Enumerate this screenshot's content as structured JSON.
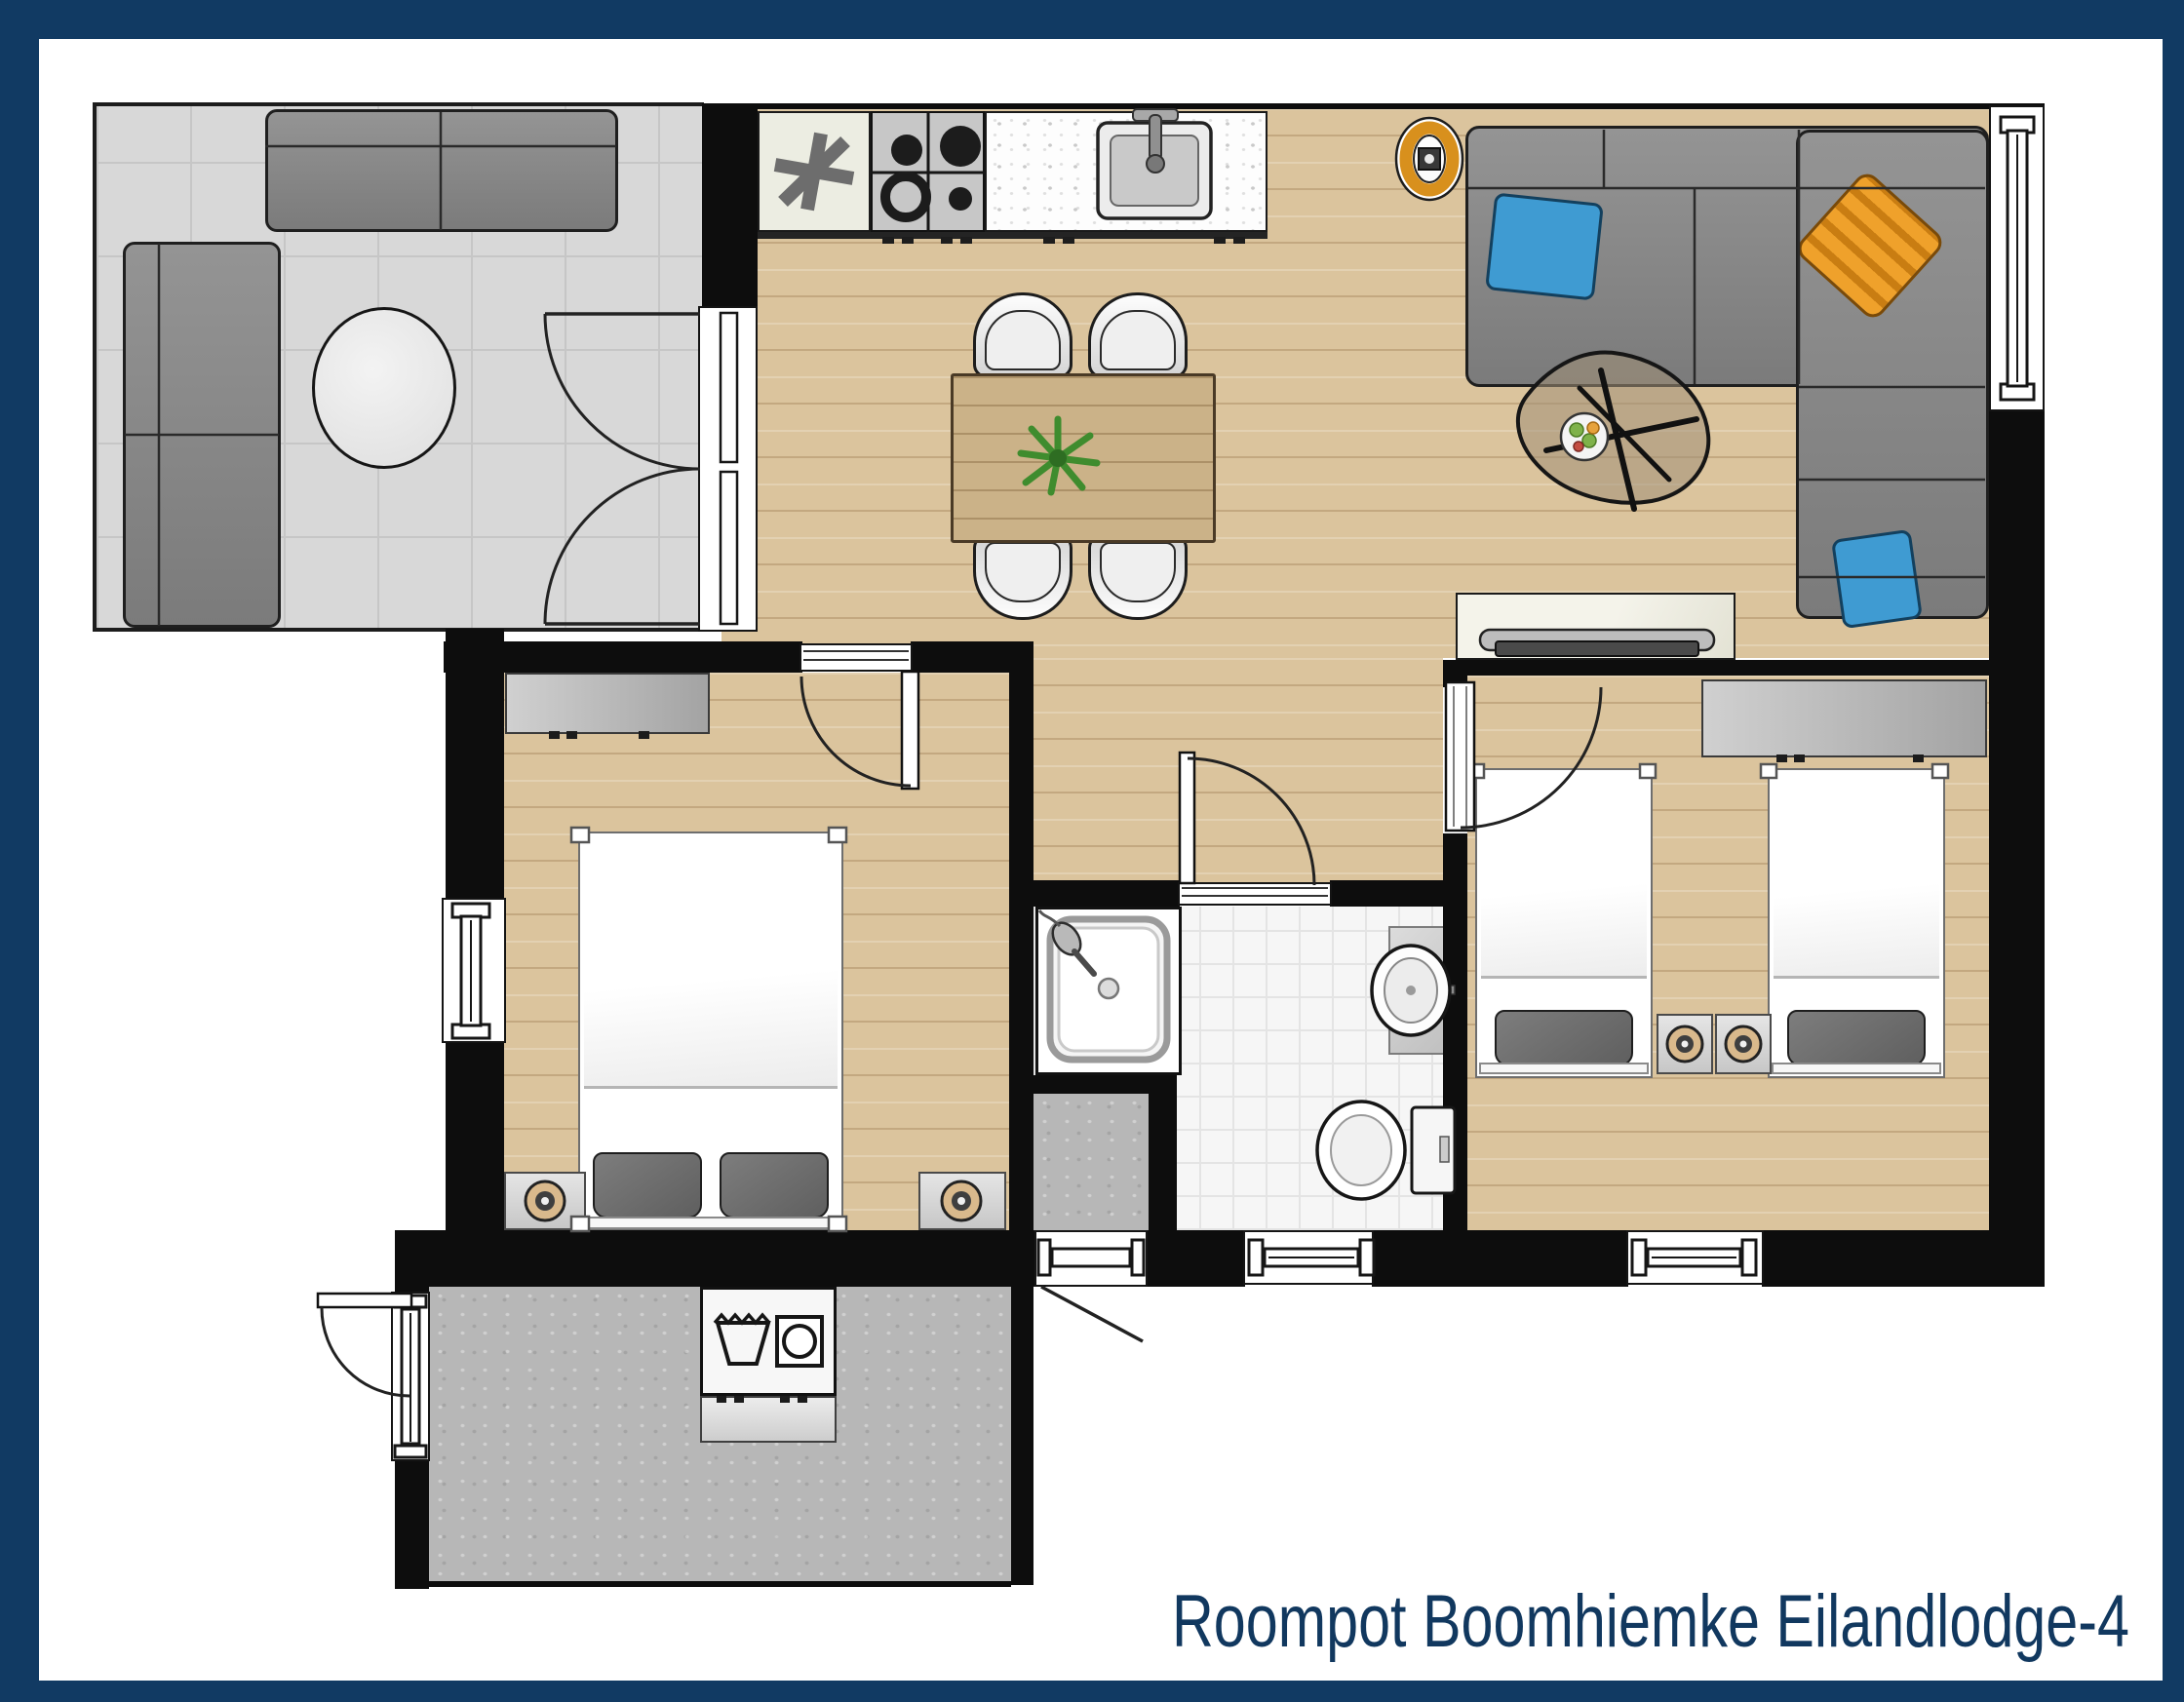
{
  "title": "Roompot Boomhiemke Eilandlodge-4",
  "frame_color": "#113a63",
  "palette": {
    "wall": "#0d0d0d",
    "wood_floor": "#dbc49d",
    "terrace_floor": "#d8d8d8",
    "bathroom_tile": "#f6f6f6",
    "utility_floor": "#b7b7b7",
    "sofa_gray": "#8a8a8a",
    "cushion_blue": "#3f9bd2",
    "cushion_orange": "#e89a25",
    "lamp_ring_orange": "#d88e1f",
    "dining_table_wood": "#cbb288",
    "title_text": "#11385f"
  },
  "rooms": {
    "terrace": {
      "furniture": [
        "outdoor-corner-sofa",
        "round-table"
      ],
      "doors": [
        "double-french-doors"
      ]
    },
    "living_kitchen": {
      "furniture": [
        "freezer-cabinet",
        "gas-hob",
        "kitchen-counter-with-sink",
        "dining-table",
        "dining-chairs",
        "potted-plant",
        "corner-sofa",
        "sofa-cushions",
        "floor-lamp",
        "coffee-table",
        "fruit-bowl",
        "tv-lowboard",
        "tv"
      ],
      "dining_chairs_count": 4,
      "sofa_cushions_count": 3,
      "hob_burners_count": 4
    },
    "bedroom_left": {
      "furniture": [
        "wardrobe",
        "double-bed",
        "bed-pillows",
        "nightstands",
        "table-lamps"
      ],
      "pillow_count": 2,
      "nightstand_count": 2,
      "window_count": 1
    },
    "bedroom_right": {
      "furniture": [
        "wardrobe",
        "single-beds",
        "nightstands",
        "table-lamps"
      ],
      "single_bed_count": 2,
      "nightstand_count": 2,
      "window_count": 1
    },
    "hallway": {
      "doors": [
        "bedroom-left-door",
        "bedroom-right-door",
        "bathroom-door"
      ]
    },
    "bathroom": {
      "furniture": [
        "shower",
        "washbasin",
        "toilet"
      ],
      "window_count": 1
    },
    "back_entry": {
      "doors": [
        "back-door"
      ]
    },
    "utility_room": {
      "furniture": [
        "washer-dryer",
        "shelf"
      ],
      "doors": [
        "entrance-door"
      ]
    }
  },
  "icons": {
    "freezer": "asterisk-icon",
    "washer": "wash-tub-icon",
    "dryer": "dryer-drum-icon"
  }
}
